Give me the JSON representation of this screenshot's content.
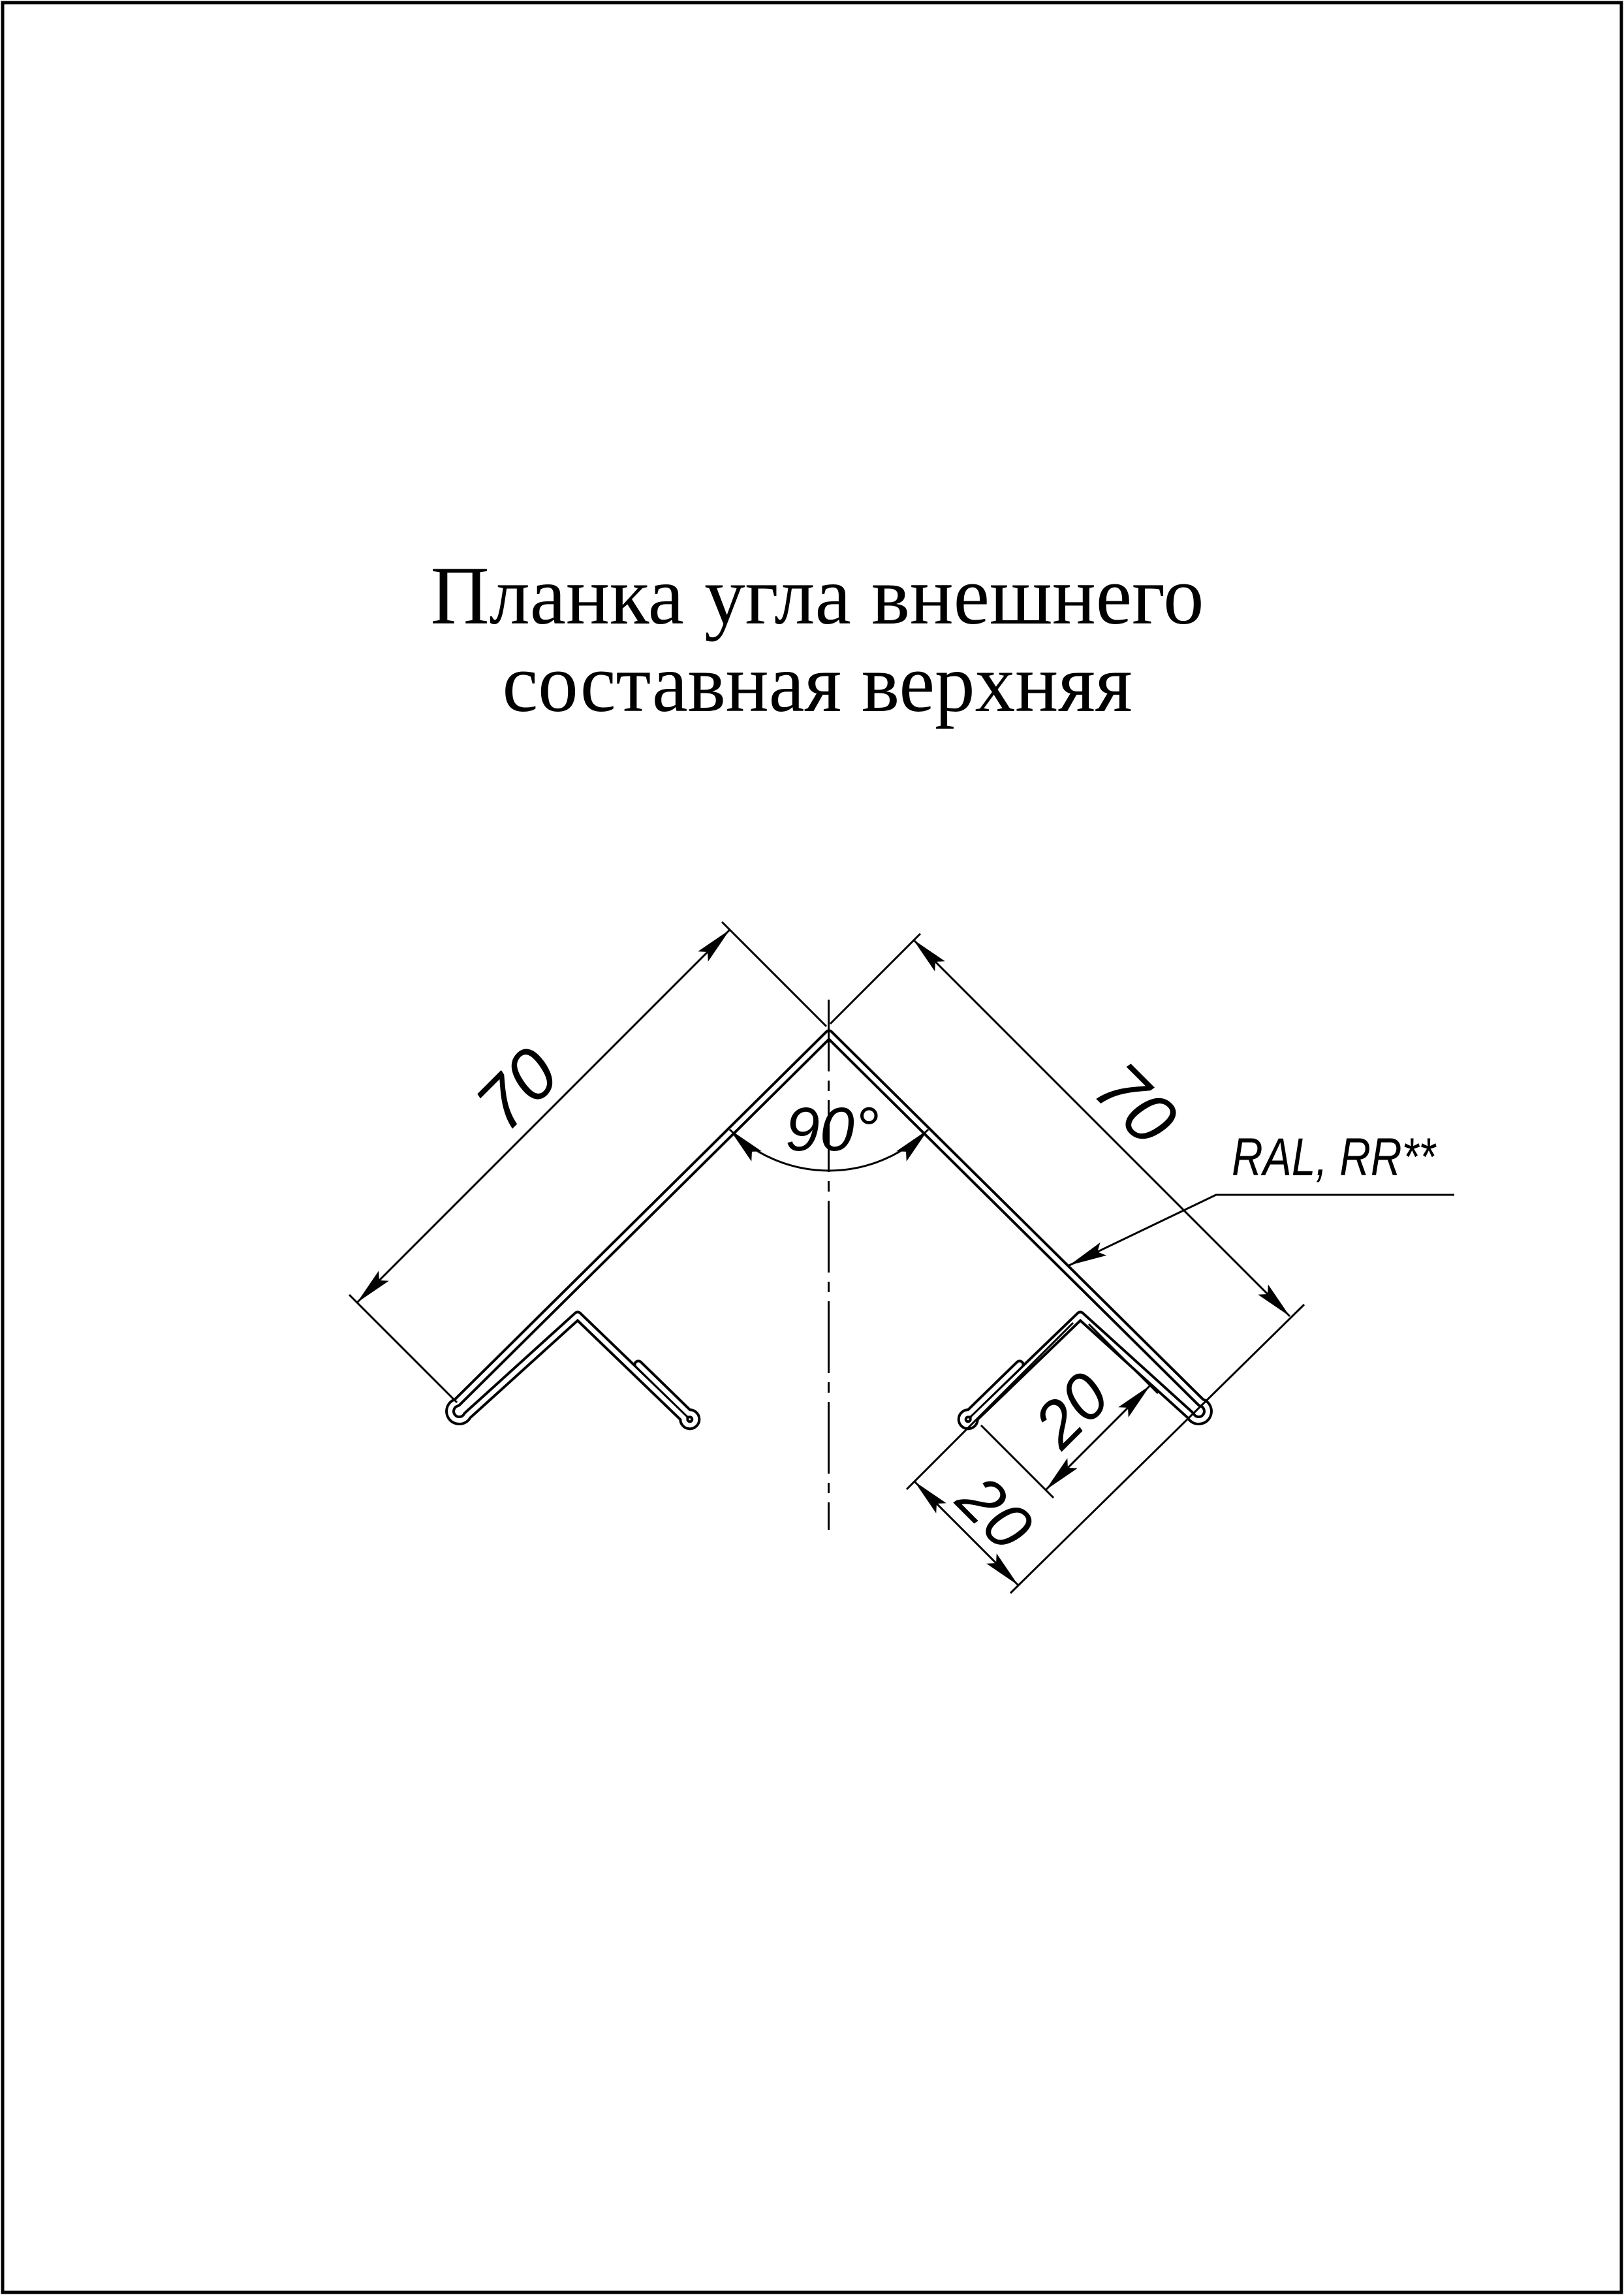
{
  "title": {
    "line1": "Планка угла внешнего",
    "line2": "составная верхняя"
  },
  "drawing": {
    "dim_left_leg": "70",
    "dim_right_leg": "70",
    "dim_angle": "90°",
    "dim_flange": "20",
    "dim_return": "20",
    "coating_label": "RAL, RR**",
    "line_color": "#000000",
    "background_color": "#ffffff"
  }
}
